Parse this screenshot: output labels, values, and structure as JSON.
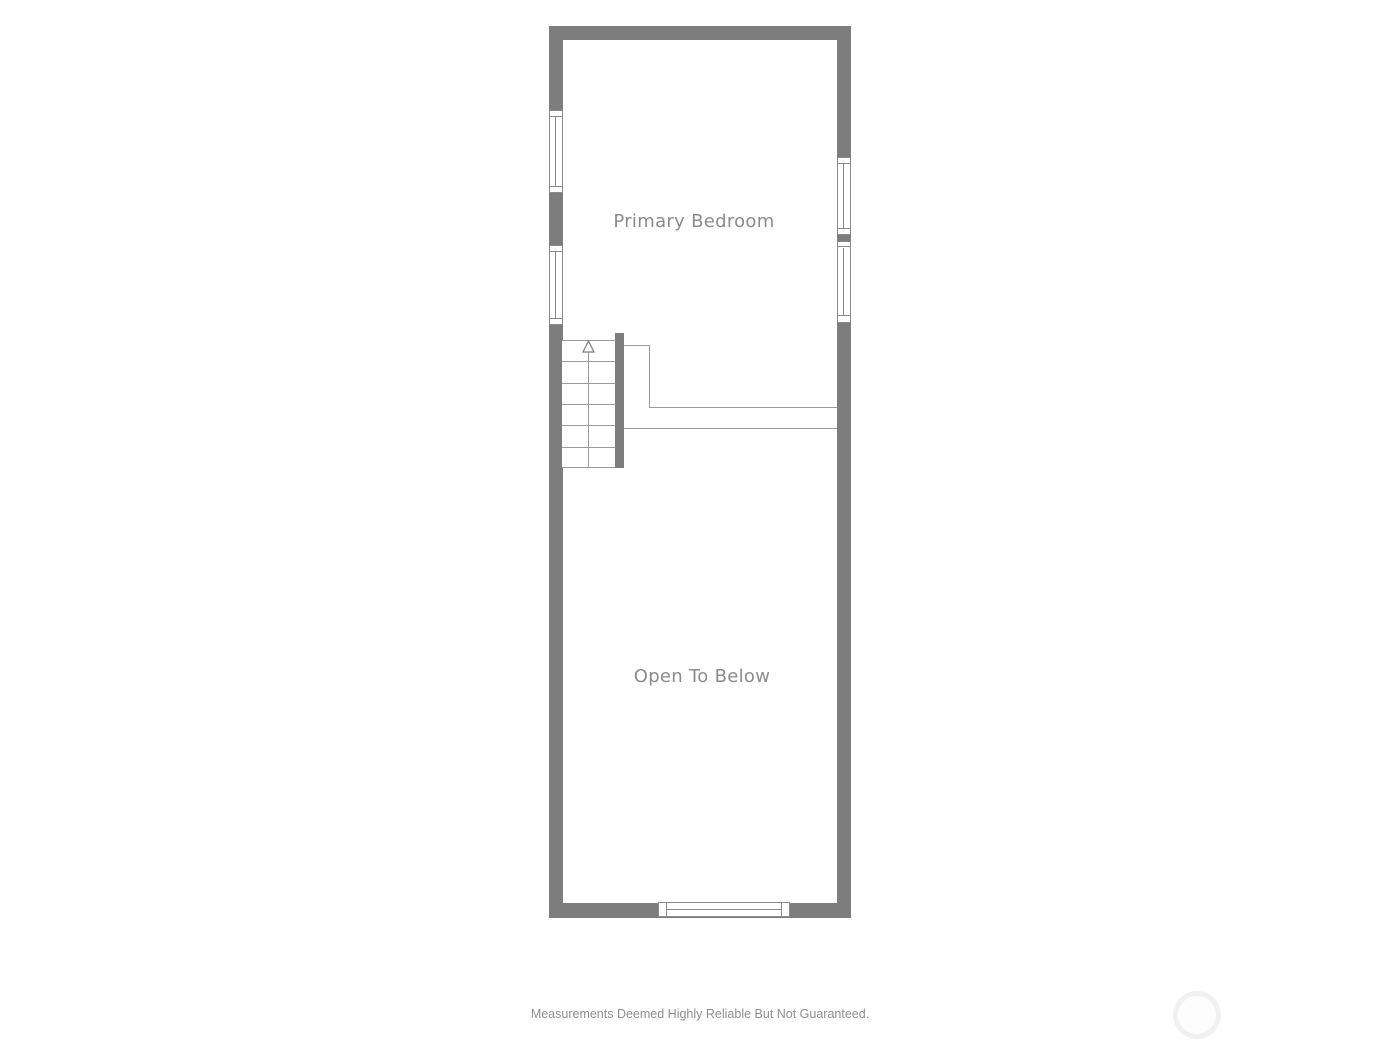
{
  "plan": {
    "rooms": [
      {
        "label": "Primary Bedroom"
      },
      {
        "label": "Open To Below"
      }
    ],
    "stairs": {
      "direction": "up",
      "tread_count": 6,
      "arrow_icon": "up-arrow"
    },
    "windows": {
      "left_wall": 2,
      "right_wall": 2,
      "bottom_wall": 1
    }
  },
  "footer": {
    "disclaimer": "Measurements Deemed Highly Reliable But Not Guaranteed."
  },
  "colors": {
    "background": "#ffffff",
    "wall": "#7d7d7d",
    "thin_line": "#9b9b9b",
    "window_border": "#8b8b8b",
    "room_label": "#8b8b8b",
    "disclaimer": "#8f8f8f",
    "watermark_ring": "#f1f1f1"
  }
}
